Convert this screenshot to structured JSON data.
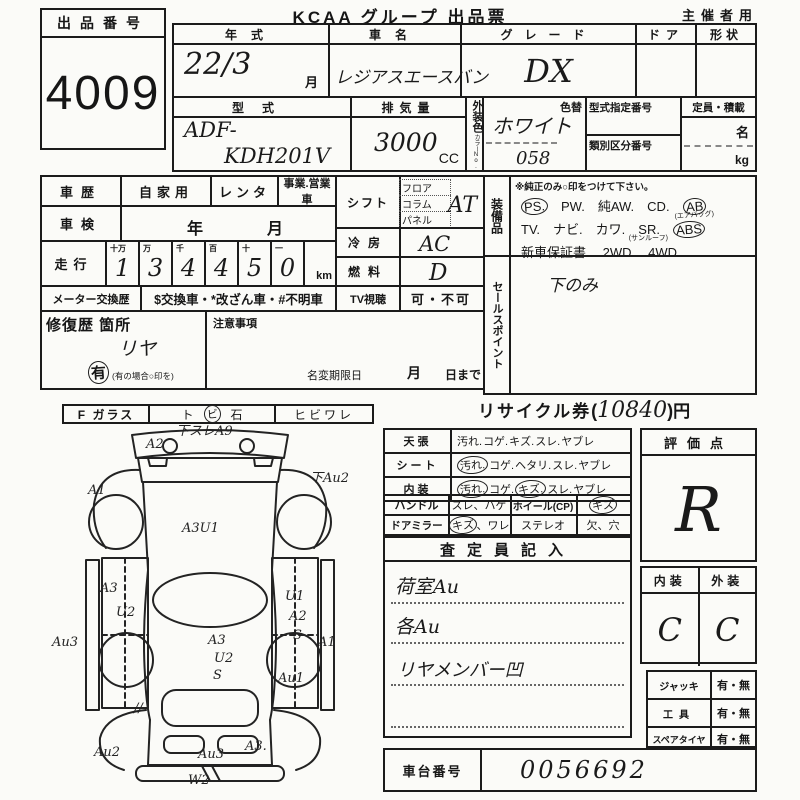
{
  "page": {
    "title": "KCAA グループ 出品票",
    "audience": "主催者用"
  },
  "auction": {
    "label": "出品番号",
    "number": "4009"
  },
  "vehicle": {
    "year_label": "年式",
    "year": "22/3",
    "month_suffix": "月",
    "name_label": "車名",
    "name": "レジアスエースバン",
    "grade_label": "グレード",
    "grade": "DX",
    "door_label": "ドア",
    "shape_label": "形状",
    "model_label": "型式",
    "model_prefix": "ADF-",
    "model_code": "KDH201V",
    "displacement_label": "排気量",
    "displacement": "3000",
    "displacement_unit": "CC",
    "ext_color_label": "外装色",
    "ext_color_sub": "カラーNo.",
    "color_change_label": "色替",
    "ext_color": "ホワイト",
    "color_no": "058",
    "type_cert_label": "型式指定番号",
    "class_no_label": "類別区分番号",
    "capacity_label": "定員・積載",
    "capacity_person": "名",
    "capacity_kg": "kg"
  },
  "history": {
    "label": "車歴",
    "private": "自家用",
    "rental": "レンタ",
    "commercial": "事業.営業車",
    "inspection_label": "車検",
    "inspection_year": "年",
    "inspection_month": "月",
    "mileage_label": "走行",
    "mileage_headers": [
      "十万",
      "万",
      "千",
      "百",
      "十",
      "一"
    ],
    "mileage_digits": [
      "1",
      "3",
      "4",
      "4",
      "5",
      "0"
    ],
    "mileage_unit": "km",
    "meter_label": "メーター交換歴",
    "meter_codes": "$交換車・*改ざん車・#不明車",
    "tv_label": "TV視聴",
    "tv_value": "可・不可"
  },
  "shift": {
    "label": "シフト",
    "options": [
      "フロア",
      "コラム",
      "パネル"
    ],
    "value": "AT"
  },
  "cooling": {
    "label": "冷房",
    "value": "AC"
  },
  "fuel": {
    "label": "燃料",
    "value": "D"
  },
  "equipment": {
    "label": "装備品",
    "note": "※純正のみ○印をつけて下さい。",
    "lines": [
      [
        {
          "t": "PS.",
          "circled": true
        },
        {
          "t": "PW."
        },
        {
          "t": "純AW."
        },
        {
          "t": "CD."
        },
        {
          "t": "AB",
          "circled": true,
          "sub": "(エアバッグ)"
        }
      ],
      [
        {
          "t": "TV."
        },
        {
          "t": "ナビ."
        },
        {
          "t": "カワ."
        },
        {
          "t": "SR.",
          "sub": "(サンルーフ)"
        },
        {
          "t": "ABS",
          "circled": true
        }
      ],
      [
        {
          "t": "新車保証書."
        },
        {
          "t": "2WD."
        },
        {
          "t": "4WD"
        }
      ]
    ]
  },
  "sales_point": {
    "label": "セールスポイント",
    "value": "下のみ"
  },
  "repair": {
    "label": "修復歴 箇所",
    "value": "リヤ",
    "has_label": "有",
    "has_note": "(有の場合○印を)"
  },
  "notes_box": {
    "label": "注意事項",
    "deadline_label": "名変期限日",
    "deadline_month": "月",
    "deadline_day": "日まで"
  },
  "recycle": {
    "label": "リサイクル券",
    "paren_open": "(",
    "amount": "10840",
    "paren_close": ")",
    "unit": "円"
  },
  "glass": {
    "label": "F ガラス",
    "opt1": "ト",
    "opt2_circled": "ビ",
    "opt3": "石",
    "opt4": "ヒビワレ"
  },
  "condition": {
    "rows": [
      {
        "label": "天張",
        "items": [
          {
            "t": "汚れ."
          },
          {
            "t": "コゲ."
          },
          {
            "t": "キズ."
          },
          {
            "t": "スレ."
          },
          {
            "t": "ヤブレ"
          }
        ]
      },
      {
        "label": "シート",
        "items": [
          {
            "t": "汚れ.",
            "circled": true
          },
          {
            "t": "コゲ."
          },
          {
            "t": "ヘタリ."
          },
          {
            "t": "スレ."
          },
          {
            "t": "ヤブレ"
          }
        ]
      },
      {
        "label": "内装",
        "items": [
          {
            "t": "汚れ.",
            "circled": true
          },
          {
            "t": "コゲ."
          },
          {
            "t": "キズ.",
            "circled": true
          },
          {
            "t": "スレ."
          },
          {
            "t": "ヤブレ"
          }
        ]
      }
    ],
    "handle_label": "ハンドル",
    "handle_opts": "スレ、ハゲ",
    "wheel_label": "ホイール(CP)",
    "wheel_opt": "キズ",
    "mirror_label": "ドアミラー",
    "mirror_opt_circled": "キズ",
    "mirror_opt_rest": "、ワレ",
    "stereo_label": "ステレオ",
    "stereo_opts": "欠、穴"
  },
  "appraiser": {
    "header": "査定員記入",
    "notes": [
      "荷室Au",
      "各Au",
      "リヤメンバー凹"
    ]
  },
  "evaluation": {
    "label": "評価点",
    "score": "R",
    "interior_label": "内装",
    "exterior_label": "外装",
    "interior": "C",
    "exterior": "C"
  },
  "accessories": [
    {
      "label": "ジャッキ",
      "value": "有・無"
    },
    {
      "label": "工具",
      "value": "有・無"
    },
    {
      "label": "スペアタイヤ",
      "value": "有・無"
    }
  ],
  "chassis": {
    "label": "車台番号",
    "number": "0056692"
  },
  "diagram": {
    "annotations": [
      {
        "x": 104,
        "y": 28,
        "t": "A2"
      },
      {
        "x": 134,
        "y": 15,
        "t": "下スレA9"
      },
      {
        "x": 46,
        "y": 74,
        "t": "A1"
      },
      {
        "x": 268,
        "y": 62,
        "t": "下Au2"
      },
      {
        "x": 140,
        "y": 112,
        "t": "A3U1"
      },
      {
        "x": 58,
        "y": 172,
        "t": "A3"
      },
      {
        "x": 74,
        "y": 196,
        "t": "U2"
      },
      {
        "x": 10,
        "y": 226,
        "t": "Au3"
      },
      {
        "x": 166,
        "y": 224,
        "t": "A3"
      },
      {
        "x": 172,
        "y": 242,
        "t": "U2"
      },
      {
        "x": 171,
        "y": 259,
        "t": "S"
      },
      {
        "x": 243,
        "y": 180,
        "t": "U1"
      },
      {
        "x": 247,
        "y": 200,
        "t": "A2"
      },
      {
        "x": 251,
        "y": 219,
        "t": "S"
      },
      {
        "x": 276,
        "y": 226,
        "t": "A1"
      },
      {
        "x": 236,
        "y": 262,
        "t": "Au1"
      },
      {
        "x": 92,
        "y": 292,
        "t": "//"
      },
      {
        "x": 52,
        "y": 336,
        "t": "Au2"
      },
      {
        "x": 156,
        "y": 338,
        "t": "Au3"
      },
      {
        "x": 203,
        "y": 330,
        "t": "A3."
      },
      {
        "x": 146,
        "y": 364,
        "t": "W2"
      }
    ]
  }
}
